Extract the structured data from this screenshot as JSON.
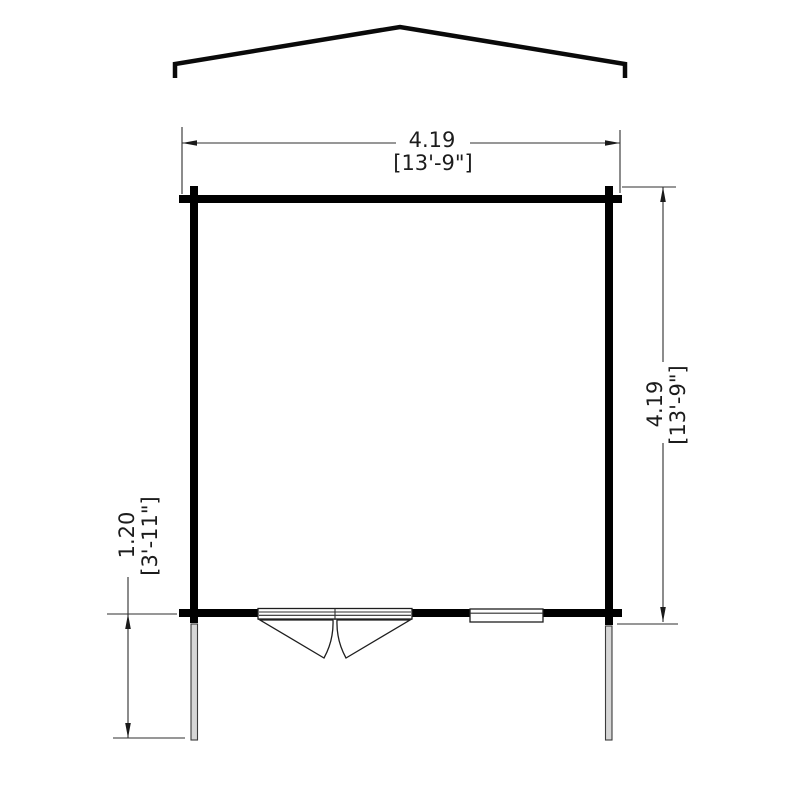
{
  "diagram": {
    "kind": "floor-plan",
    "dims": {
      "width": {
        "metric": "4.19",
        "imperial": "[13'-9\"]"
      },
      "depth": {
        "metric": "4.19",
        "imperial": "[13'-9\"]"
      },
      "porch": {
        "metric": "1.20",
        "imperial": "[3'-11\"]"
      }
    },
    "colors": {
      "wall": "#000000",
      "roof_line": "#0a0a0a",
      "thin_line": "#2f2f2f",
      "text": "#1c1c1c",
      "post_fill": "#d6d6d6",
      "background": "#ffffff"
    }
  }
}
